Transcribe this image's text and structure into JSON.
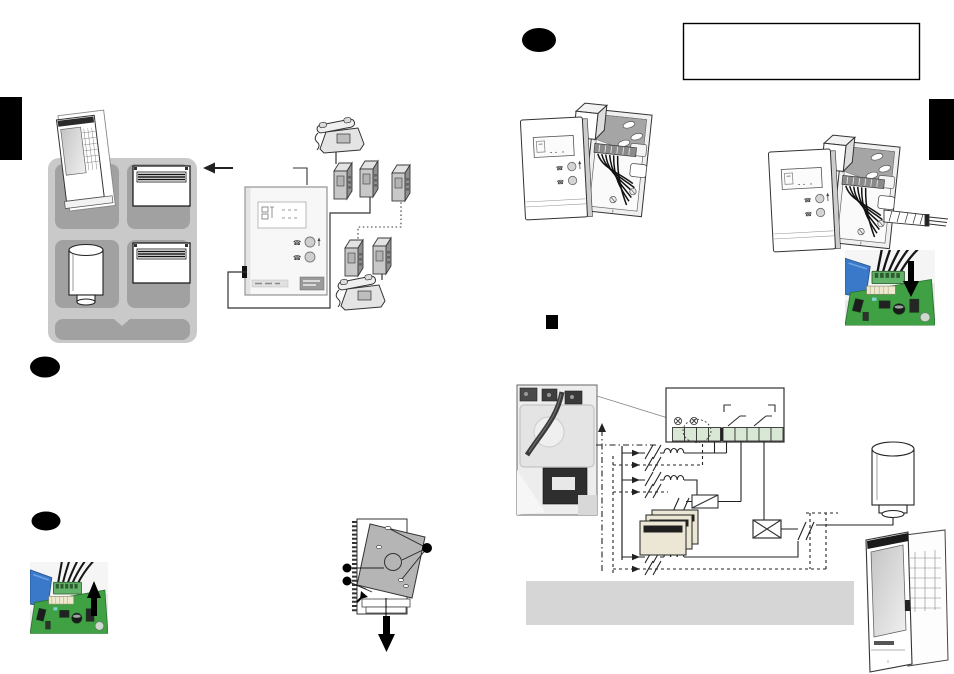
{
  "page": {
    "width": 954,
    "height": 674,
    "background": "#ffffff"
  },
  "colors": {
    "black": "#000000",
    "line": "#2b2b2b",
    "grid_frame": "#c9c9c9",
    "grid_cell": "#a1a1a1",
    "terminal_green": "#d9e7d5",
    "heater_beige": "#ece7d4",
    "gray_band": "#d6d6d6",
    "cover_gray": "#b5b5b5",
    "pcb_green": "#3fa044",
    "pcb_connector_green": "#63b269",
    "pcb_blue": "#3a78c9",
    "adapter_gray": "#c8c8c8",
    "photo_bg": "#e9e9e9"
  },
  "icons": {
    "phone_glyph": "☎"
  },
  "marks": {
    "step_badges": [
      {
        "shape": "black-oval",
        "page": "left",
        "cx": 45,
        "cy": 367
      },
      {
        "shape": "black-oval",
        "page": "left",
        "cx": 46,
        "cy": 521
      },
      {
        "shape": "black-oval",
        "page": "right",
        "cx": 539,
        "cy": 40
      }
    ],
    "bullet_square": {
      "shape": "black-square",
      "x": 546,
      "y": 315
    },
    "note_box": {
      "text": "",
      "x": 683,
      "y": 23,
      "width": 237,
      "height": 57
    },
    "page_tabs": [
      {
        "edge": "left",
        "y": 97
      },
      {
        "edge": "right",
        "y": 99
      }
    ]
  },
  "figures": [
    {
      "name": "system-overview-grid"
    },
    {
      "name": "central-control-unit"
    },
    {
      "name": "telephone-socket-network"
    },
    {
      "name": "pcb-connector-photo-unplug"
    },
    {
      "name": "cover-removal-diagram"
    },
    {
      "name": "wall-unit-open-left"
    },
    {
      "name": "wall-unit-open-right"
    },
    {
      "name": "pcb-connector-photo-plug"
    },
    {
      "name": "junction-box-photo"
    },
    {
      "name": "wiring-schematic"
    }
  ]
}
